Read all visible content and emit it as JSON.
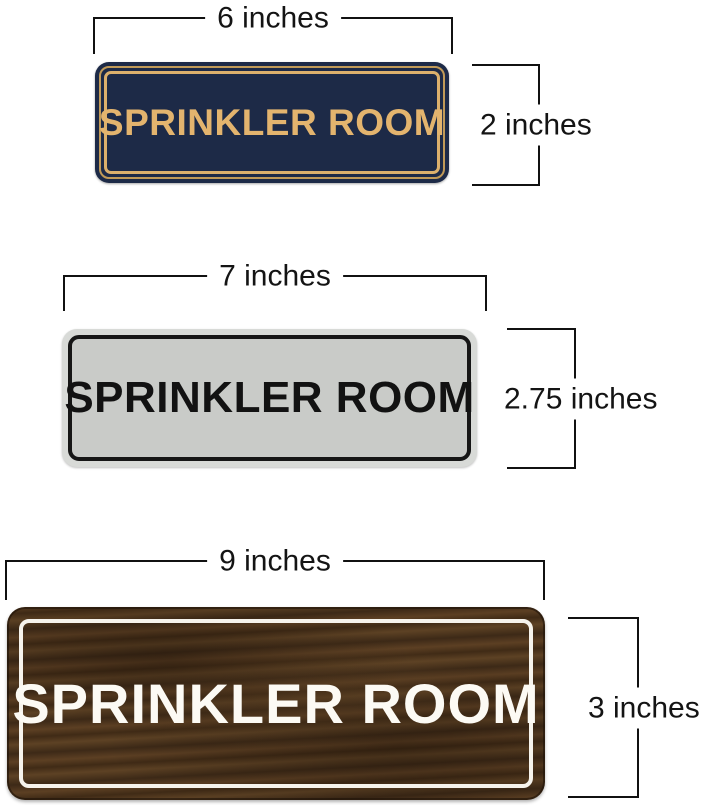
{
  "page": {
    "background_color": "#ffffff",
    "dimension_line_color": "#111111"
  },
  "signs": [
    {
      "id": "navy-gold-sign",
      "label": "SPRINKLER ROOM",
      "width_label": "6 inches",
      "height_label": "2 inches",
      "colors": {
        "background": "#1d2a47",
        "border_outer": "#c19a58",
        "border_inner": "#dcb06c",
        "text": "#e3b46e"
      }
    },
    {
      "id": "silver-black-sign",
      "label": "SPRINKLER ROOM",
      "width_label": "7 inches",
      "height_label": "2.75 inches",
      "colors": {
        "rim": "#d8dad7",
        "background": "#c9cbc8",
        "border": "#161616",
        "text": "#121212"
      }
    },
    {
      "id": "walnut-wood-sign",
      "label": "SPRINKLER ROOM",
      "width_label": "9 inches",
      "height_label": "3 inches",
      "colors": {
        "background": "#4e351d",
        "border": "#f6f3ec",
        "text": "#fcfaf4"
      }
    }
  ]
}
